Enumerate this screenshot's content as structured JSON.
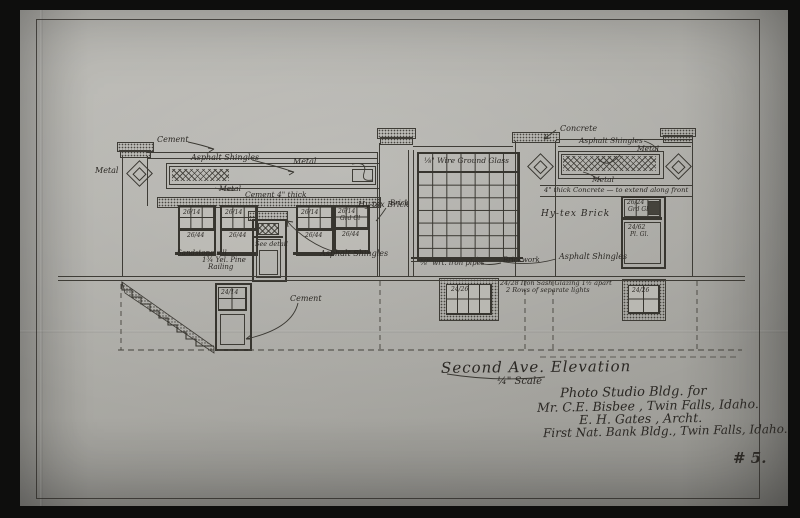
{
  "photo": {
    "sheet_number": "# 5."
  },
  "title": {
    "name": "Second Ave. Elevation",
    "scale": "¼\" Scale"
  },
  "title_block": {
    "line1": "Photo Studio Bldg.  for",
    "line2": "Mr. C.E. Bisbee ,   Twin Falls, Idaho.",
    "line3": "E. H. Gates , Archt.",
    "line4": "First Nat. Bank Bldg.,  Twin Falls, Idaho."
  },
  "materials": {
    "cement": "Cement",
    "metal": "Metal",
    "asphalt_shingles": "Asphalt Shingles",
    "cement_4_thick": "Cement 4\" thick",
    "hytex_brick": "Hy-tex Brick",
    "sandstone_sill": "Sandstone sill",
    "yel_pine_1": "1¾ Yel. Pine",
    "yel_pine_2": "Railing",
    "see_detail": "See detail",
    "brick": "Brick",
    "brickwork": "Brickwork",
    "wire_ground_glass": "⅛\" Wire Ground Glass",
    "concrete": "Concrete",
    "concrete_band": "4\" thick Concrete — to extend along front",
    "iron_pipes": "⅜\" wrt. iron pipes",
    "iron_sash_1": "24/28 Iron Sash Glazing 1½ apart",
    "iron_sash_2": "2 Rows of separate lights"
  },
  "glass": {
    "upper": "26/14",
    "lower": "26/44",
    "grd_abbrev": "Grd Gl",
    "door_basement": "24/14",
    "top_right_size": "26/24",
    "top_right_kind": "Grd Gl",
    "low_right_size": "24/62",
    "low_right_kind": "Pl. Gl.",
    "basement": "24/26"
  },
  "colors": {
    "photo_border": "#0e0e0d",
    "sheet": "#b3b2ac",
    "ink": "#37352f"
  }
}
